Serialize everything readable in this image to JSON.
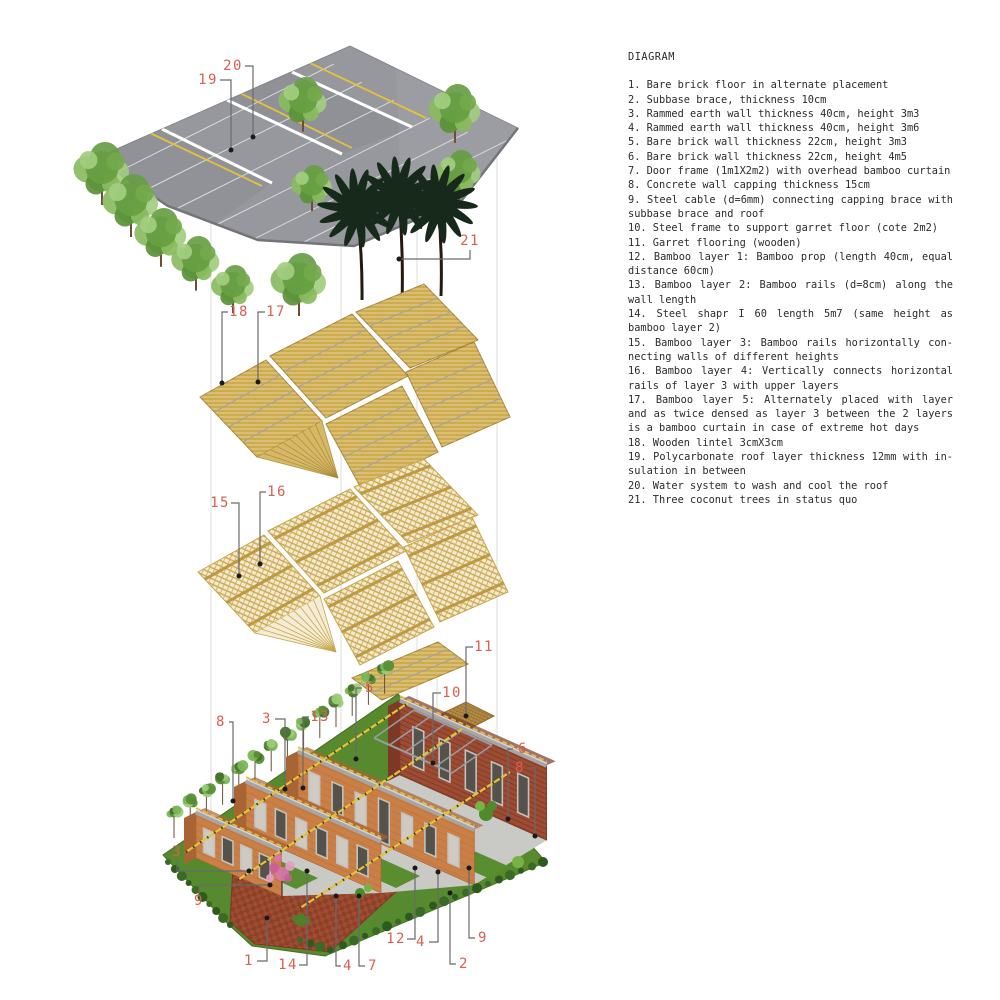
{
  "legend": {
    "title": "DIAGRAM",
    "items": [
      {
        "n": "1",
        "text": "Bare brick floor in alternate placement"
      },
      {
        "n": "2",
        "text": "Subbase brace, thickness 10cm"
      },
      {
        "n": "3",
        "text": "Rammed earth wall thickness 40cm, height 3m3"
      },
      {
        "n": "4",
        "text": "Rammed earth wall thickness 40cm, height 3m6"
      },
      {
        "n": "5",
        "text": "Bare brick wall thickness 22cm, height 3m3"
      },
      {
        "n": "6",
        "text": "Bare brick wall thickness 22cm, height 4m5"
      },
      {
        "n": "7",
        "text": "Door frame (1m1X2m2) with overhead bamboo curtain"
      },
      {
        "n": "8",
        "text": "Concrete wall capping thickness 15cm"
      },
      {
        "n": "9",
        "text": "Steel cable (d=6mm) connecting capping brace with subbase brace and roof"
      },
      {
        "n": "10",
        "text": "Steel frame to support garret floor (cote 2m2)"
      },
      {
        "n": "11",
        "text": "Garret flooring (wooden)"
      },
      {
        "n": "12",
        "text": "Bamboo layer 1: Bamboo prop (length 40cm, equal distance 60cm)"
      },
      {
        "n": "13",
        "text": "Bamboo layer 2: Bamboo rails (d=8cm) along the wall length"
      },
      {
        "n": "14",
        "text": "Steel shapr I 60 length 5m7 (same height as bamboo layer 2)"
      },
      {
        "n": "15",
        "text": "Bamboo layer 3: Bamboo rails horizontally con-necting walls of different heights"
      },
      {
        "n": "16",
        "text": "Bamboo layer 4: Vertically connects horizontal rails of layer 3 with upper layers"
      },
      {
        "n": "17",
        "text": "Bamboo layer 5: Alternately placed with layer and as twice densed as layer 3 between the 2 layers is a bamboo curtain in case of extreme hot days"
      },
      {
        "n": "18",
        "text": "Wooden lintel 3cmX3cm"
      },
      {
        "n": "19",
        "text": "Polycarbonate roof layer thickness 12mm with in-sulation in between"
      },
      {
        "n": "20",
        "text": "Water system to wash and cool the roof"
      },
      {
        "n": "21",
        "text": "Three coconut trees in status quo"
      }
    ]
  },
  "callouts": [
    {
      "id": "callout-19",
      "n": "19",
      "cx": 208,
      "cy": 80,
      "points": "220,80 231,80 231,150",
      "dot": [
        231,
        150
      ]
    },
    {
      "id": "callout-20",
      "n": "20",
      "cx": 233,
      "cy": 66,
      "points": "245,66 253,66 253,137",
      "dot": [
        253,
        137
      ]
    },
    {
      "id": "callout-21",
      "n": "21",
      "cx": 470,
      "cy": 241,
      "points": "470,250 470,259 399,259",
      "dot": [
        399,
        259
      ]
    },
    {
      "id": "callout-18",
      "n": "18",
      "cx": 239,
      "cy": 312,
      "points": "228,312 222,312 222,383",
      "dot": [
        222,
        383
      ]
    },
    {
      "id": "callout-17",
      "n": "17",
      "cx": 276,
      "cy": 312,
      "points": "265,312 258,312 258,382",
      "dot": [
        258,
        382
      ]
    },
    {
      "id": "callout-15",
      "n": "15",
      "cx": 220,
      "cy": 503,
      "points": "231,503 239,503 239,576",
      "dot": [
        239,
        576
      ]
    },
    {
      "id": "callout-16",
      "n": "16",
      "cx": 277,
      "cy": 492,
      "points": "266,492 260,492 260,564",
      "dot": [
        260,
        564
      ]
    },
    {
      "id": "callout-11",
      "n": "11",
      "cx": 484,
      "cy": 647,
      "points": "473,647 466,647 466,716",
      "dot": [
        466,
        716
      ]
    },
    {
      "id": "callout-5",
      "n": "5",
      "cx": 370,
      "cy": 688,
      "points": "362,688 356,688 356,759",
      "dot": [
        356,
        759
      ]
    },
    {
      "id": "callout-10",
      "n": "10",
      "cx": 452,
      "cy": 693,
      "points": "441,693 433,693 433,763",
      "dot": [
        433,
        763
      ]
    },
    {
      "id": "callout-6",
      "n": "6",
      "cx": 523,
      "cy": 749,
      "points": "513,749 508,749 508,819",
      "dot": [
        508,
        819
      ]
    },
    {
      "id": "callout-8-right",
      "n": "8",
      "cx": 520,
      "cy": 768,
      "points": "528,768 535,768 535,836",
      "dot": [
        535,
        836
      ]
    },
    {
      "id": "callout-8-left",
      "n": "8",
      "cx": 221,
      "cy": 722,
      "points": "229,722 233,722 233,801",
      "dot": [
        233,
        801
      ]
    },
    {
      "id": "callout-3-top",
      "n": "3",
      "cx": 267,
      "cy": 719,
      "points": "275,719 285,719 285,789",
      "dot": [
        285,
        789
      ]
    },
    {
      "id": "callout-13",
      "n": "13",
      "cx": 320,
      "cy": 717,
      "points": "309,717 303,717 303,788",
      "dot": [
        303,
        788
      ]
    },
    {
      "id": "callout-3-left",
      "n": "3",
      "cx": 177,
      "cy": 852,
      "points": "177,861 177,871 249,871",
      "dot": [
        249,
        871
      ]
    },
    {
      "id": "callout-9-left",
      "n": "9",
      "cx": 199,
      "cy": 901,
      "points": "199,892 199,885 270,885",
      "dot": [
        270,
        885
      ]
    },
    {
      "id": "callout-1",
      "n": "1",
      "cx": 249,
      "cy": 961,
      "points": "257,961 267,961 267,918",
      "dot": [
        267,
        918
      ]
    },
    {
      "id": "callout-14",
      "n": "14",
      "cx": 288,
      "cy": 965,
      "points": "299,965 307,965 307,871",
      "dot": [
        307,
        871
      ]
    },
    {
      "id": "callout-4-left",
      "n": "4",
      "cx": 348,
      "cy": 966,
      "points": "341,966 336,966 336,896",
      "dot": [
        336,
        896
      ]
    },
    {
      "id": "callout-7",
      "n": "7",
      "cx": 373,
      "cy": 966,
      "points": "365,966 359,966 359,896",
      "dot": [
        359,
        896
      ]
    },
    {
      "id": "callout-12",
      "n": "12",
      "cx": 396,
      "cy": 939,
      "points": "407,939 415,939 415,868",
      "dot": [
        415,
        868
      ]
    },
    {
      "id": "callout-4-right",
      "n": "4",
      "cx": 421,
      "cy": 942,
      "points": "429,942 438,942 438,872",
      "dot": [
        438,
        872
      ]
    },
    {
      "id": "callout-2",
      "n": "2",
      "cx": 464,
      "cy": 964,
      "points": "456,964 450,964 450,893",
      "dot": [
        450,
        893
      ]
    },
    {
      "id": "callout-9-right",
      "n": "9",
      "cx": 483,
      "cy": 938,
      "points": "475,938 469,938 469,868",
      "dot": [
        469,
        868
      ]
    }
  ],
  "colors": {
    "label_red": "#d95f50",
    "leader_gray": "#6a6a6a",
    "dot_black": "#1a1a1a",
    "legend_text": "#2b2b2b",
    "roof_gray": "#97989d",
    "roof_edge": "#74757a",
    "roof_line_white": "#e8e9ec",
    "water_yellow": "#e4c33a",
    "bamboo_gold": "#d2b054",
    "bamboo_edge": "#a5853a",
    "bamboo_line_gray": "#9fa1a6",
    "lattice_base": "#f4ead0",
    "lattice_tan": "#c7a64e",
    "lattice_band": "#bb9740",
    "garret_brown": "#b78e44",
    "wall_earth": "#c97f45",
    "wall_earth_end": "#a96434",
    "wall_brick": "#9d4b33",
    "wall_brick_end": "#7e3826",
    "capping_gray": "#a6a6a6",
    "capping_hi": "#d6d6d6",
    "floor_gray": "#c9c9c5",
    "lawn_green": "#578a2e",
    "grass_light": "#5a8c30",
    "hedge_green": "#2d5a1d",
    "plaza_brick": "#a04c31",
    "plaza_brick_dark": "#8c3f28",
    "tree_greens": [
      "#8abb5f",
      "#679e43",
      "#a3cd80",
      "#74a84c",
      "#5b9138"
    ],
    "bamboo_tree_greens": [
      "#7cb556",
      "#578e36",
      "#9ccb78",
      "#44722c"
    ],
    "palm_green": "#1d3520",
    "palm_dark": "#16291a",
    "trunk_brown": "#6b4e35",
    "palm_trunk": "#241a12",
    "steel_gray": "#989da3",
    "guide_gray": "#dcdcdc",
    "pink_tree": [
      "#d977ac",
      "#c75f9b",
      "#e79cc4"
    ]
  }
}
